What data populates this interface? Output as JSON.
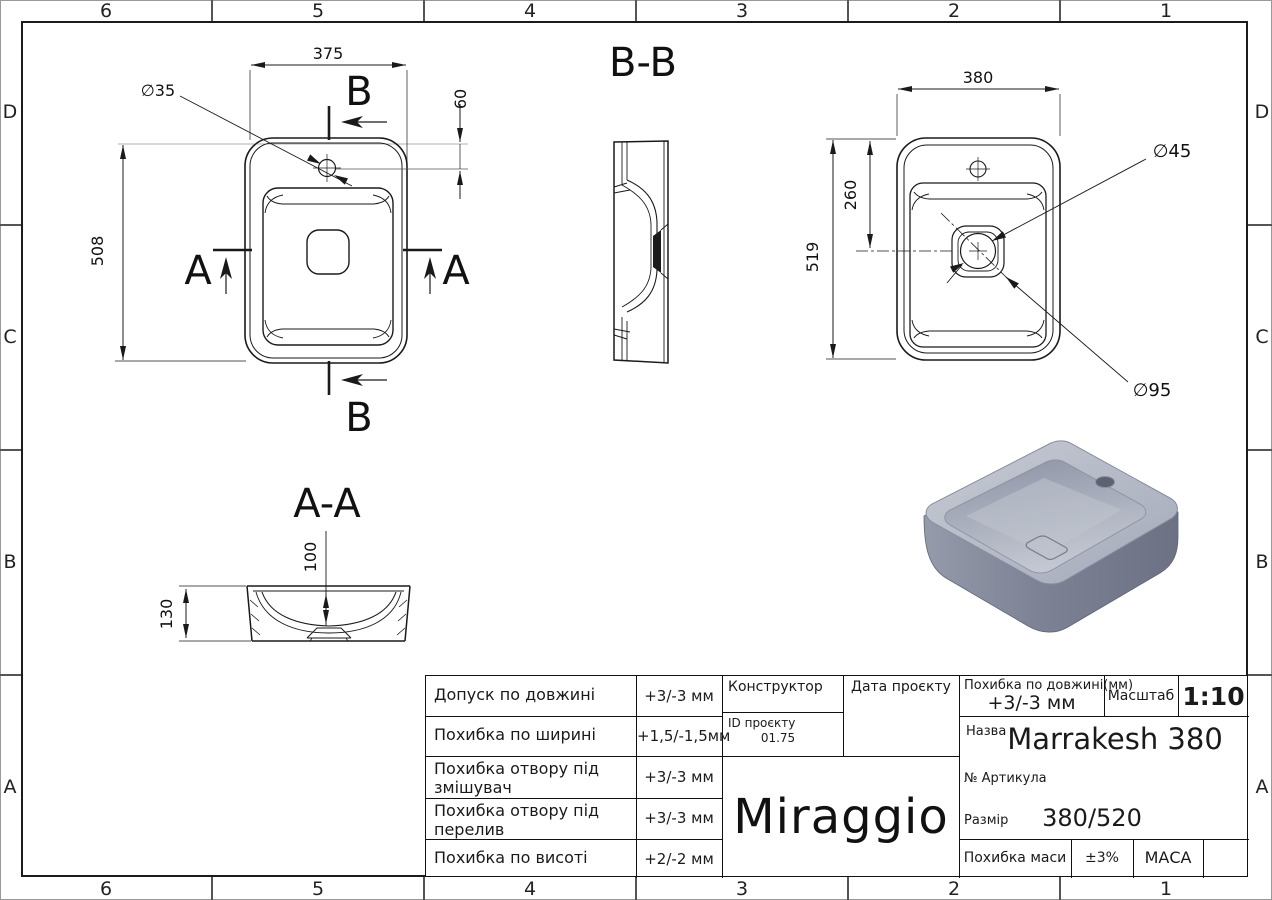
{
  "drawing": {
    "grid": {
      "columns": [
        "6",
        "5",
        "4",
        "3",
        "2",
        "1"
      ],
      "rows": [
        "D",
        "C",
        "B",
        "A"
      ]
    },
    "section_labels": {
      "b": "B",
      "a": "A",
      "bb": "B-B",
      "aa": "A-A"
    },
    "dimensions": {
      "plan_width": "375",
      "plan_height": "508",
      "faucet_hole_diameter": "∅35",
      "faucet_hole_offset": "60",
      "bottom_width": "380",
      "bottom_height": "519",
      "drain_offset": "260",
      "drain_diameter": "∅45",
      "recess_diameter": "∅95",
      "bowl_depth": "100",
      "overall_height": "130"
    }
  },
  "title_block": {
    "tolerances": [
      {
        "label": "Допуск по довжині",
        "value": "+3/-3 мм"
      },
      {
        "label": "Похибка по ширині",
        "value": "+1,5/-1,5мм"
      },
      {
        "label": "Похибка отвору під змішувач",
        "value": "+3/-3 мм"
      },
      {
        "label": "Похибка отвору під перелив",
        "value": "+3/-3 мм"
      },
      {
        "label": "Похибка по висоті",
        "value": "+2/-2 мм"
      }
    ],
    "constructor_label": "Конструктор",
    "project_date_label": "Дата проєкту",
    "project_id_label": "ID проєкту",
    "project_id_value": "01.75",
    "logo": "Miraggio",
    "length_tolerance_label": "Похибка по довжині(мм)",
    "length_tolerance_value": "+3/-3 мм",
    "scale_label": "Масштаб",
    "scale_value": "1:10",
    "name_label": "Назва",
    "name_value": "Marrakesh 380",
    "article_label": "№ Артикула",
    "size_label": "Размір",
    "size_value": "380/520",
    "mass_tolerance_label": "Похибка маси",
    "mass_tolerance_value": "±3%",
    "mass_label": "МАСА"
  },
  "colors": {
    "line": "#1a1a1a",
    "construction_line": "#b3b3b3",
    "render_body_dark": "#6c7183",
    "render_body_light": "#959bab",
    "render_deck": "#bcc1cc",
    "render_bowl_shadow": "#8b92a4",
    "render_bowl_light": "#c3c7d1"
  }
}
